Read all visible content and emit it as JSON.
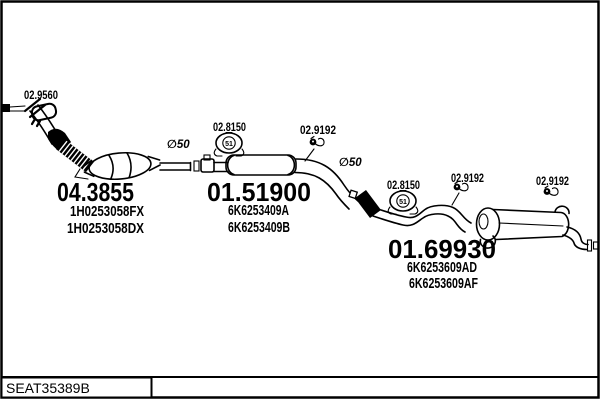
{
  "diagram": {
    "front": {
      "clamp_label": "02.9560",
      "diameter_label": "∅50",
      "part_code": "04.3855",
      "oem_1": "1H0253058FX",
      "oem_2": "1H0253058DX"
    },
    "middle": {
      "mount_label": "02.8150",
      "mount_size": "51",
      "hanger_label": "02.9192",
      "diameter_label": "∅50",
      "part_code": "01.51900",
      "oem_1": "6K6253409A",
      "oem_2": "6K6253409B"
    },
    "rear": {
      "mount_label": "02.8150",
      "mount_size": "51",
      "hanger_label_1": "02.9192",
      "hanger_label_2": "02.9192",
      "part_code": "01.69930",
      "oem_1": "6K6253609AD",
      "oem_2": "6K6253609AF"
    }
  },
  "footer": {
    "catalog_id": "SEAT35389B"
  },
  "colors": {
    "line": "#000000",
    "background": "#ffffff"
  }
}
